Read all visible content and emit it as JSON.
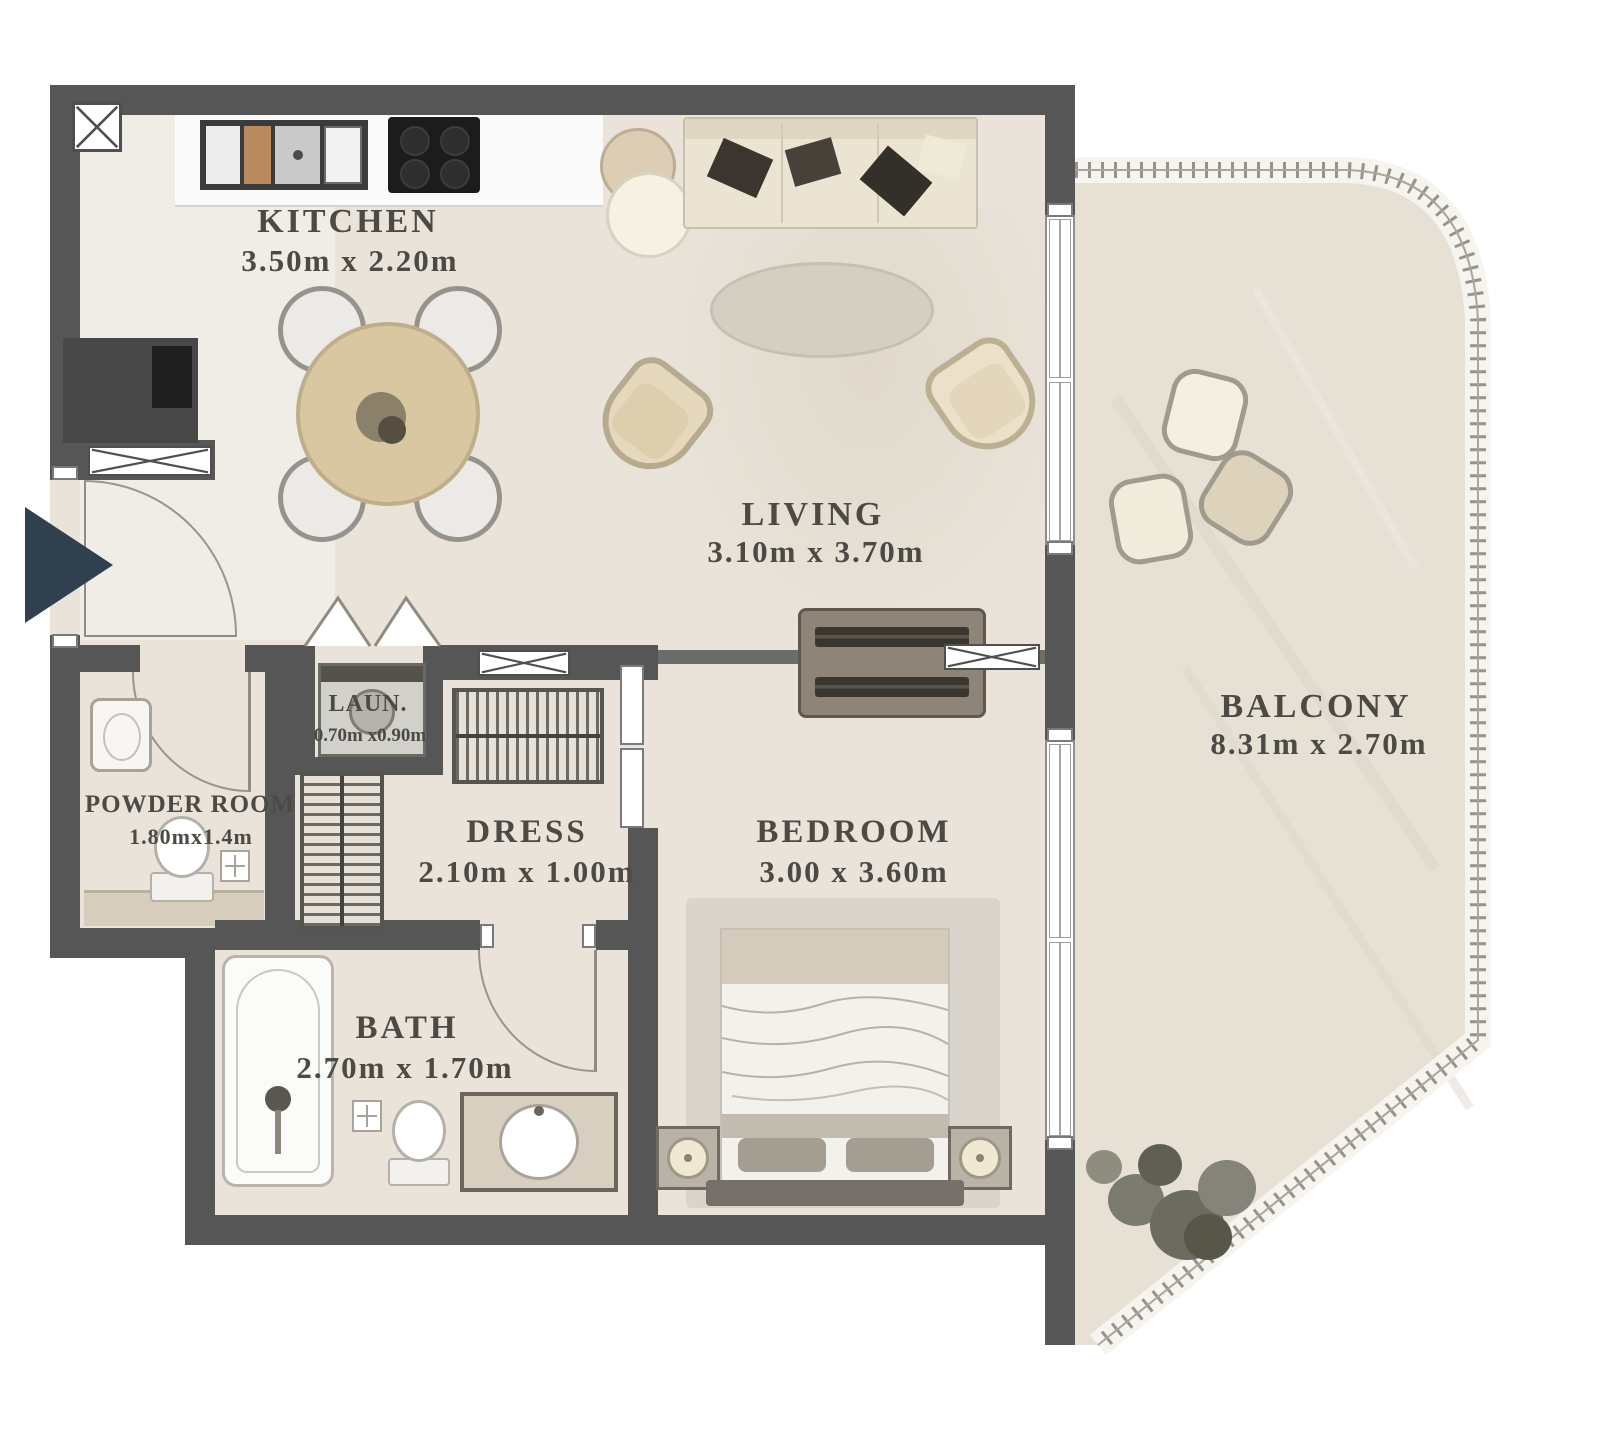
{
  "title": "Apartment floor plan",
  "colors": {
    "wall": "#565656",
    "floor": "#e9e3d9",
    "balcony_floor": "#e7e1d5",
    "entry_arrow": "#31404f",
    "label_text": "#4b4a45"
  },
  "rooms": [
    {
      "id": "kitchen",
      "label": "KITCHEN",
      "dims": "3.50m x 2.20m"
    },
    {
      "id": "living",
      "label": "LIVING",
      "dims": "3.10m x 3.70m"
    },
    {
      "id": "balcony",
      "label": "BALCONY",
      "dims": "8.31m x 2.70m"
    },
    {
      "id": "powder-room",
      "label": "POWDER ROOM",
      "dims": "1.80mx1.4m"
    },
    {
      "id": "laundry",
      "label": "LAUN.",
      "dims": "0.70m x0.90m"
    },
    {
      "id": "dress",
      "label": "DRESS",
      "dims": "2.10m x 1.00m"
    },
    {
      "id": "bedroom",
      "label": "BEDROOM",
      "dims": "3.00 x 3.60m"
    },
    {
      "id": "bath",
      "label": "BATH",
      "dims": "2.70m x 1.70m"
    }
  ]
}
